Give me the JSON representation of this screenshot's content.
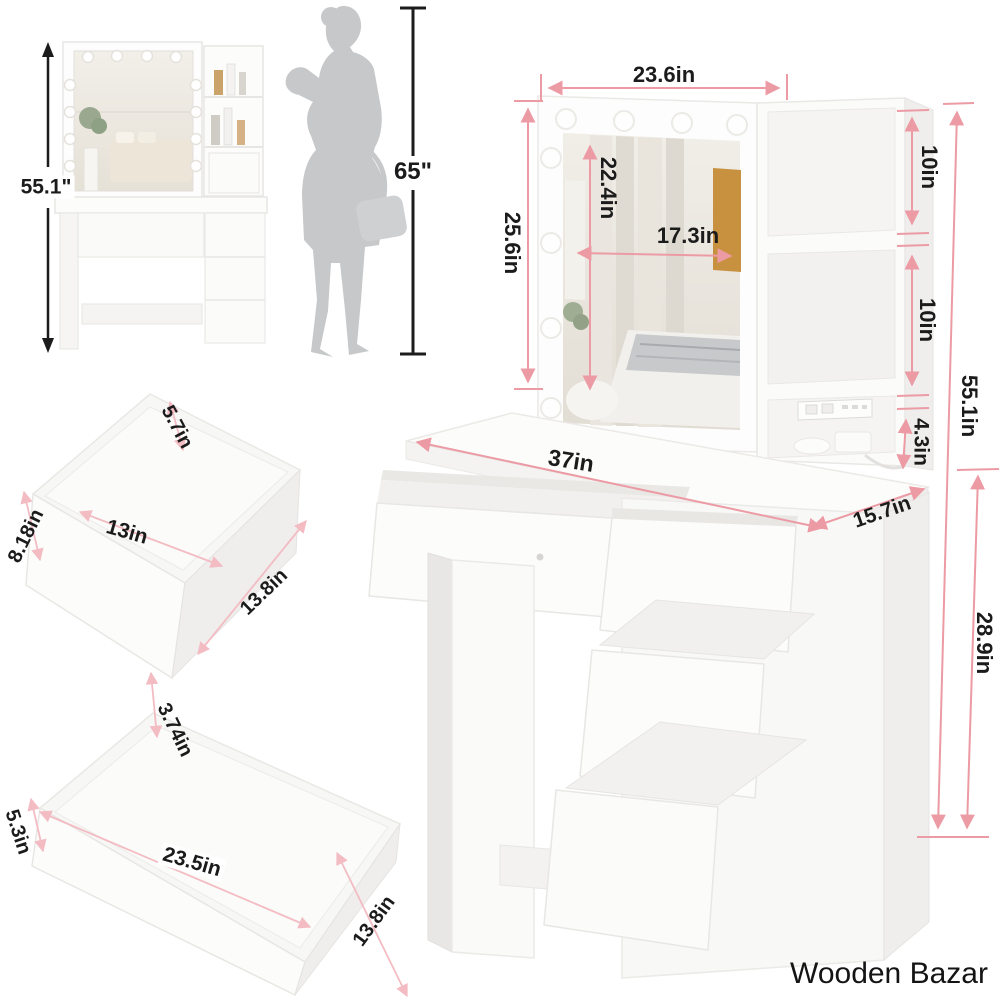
{
  "brand": "Wooden Bazar",
  "reference_photo": {
    "height": "55.1\""
  },
  "person": {
    "height": "65\""
  },
  "vanity": {
    "top_width": "23.6in",
    "left_panel_height": "25.6in",
    "mirror_height": "22.4in",
    "mirror_width": "17.3in",
    "shelf_top_height": "10in",
    "shelf_middle_height": "10in",
    "shelf_bottom_height": "4.3in",
    "total_height": "55.1in",
    "desk_width": "37in",
    "desk_depth": "15.7in",
    "cabinet_height": "28.9in"
  },
  "top_drawer": {
    "height": "5.7in",
    "inner_width": "13in",
    "side_height": "8.18in",
    "depth": "13.8in"
  },
  "bottom_drawer": {
    "height": "3.74in",
    "side_height": "5.3in",
    "width": "23.5in",
    "depth": "13.8in"
  },
  "colors": {
    "dimension_pink": "#ec9ba5",
    "dimension_black": "#1c1c1c",
    "silhouette_gray": "#c6c8ca",
    "furniture_white": "#fbfbfa"
  }
}
